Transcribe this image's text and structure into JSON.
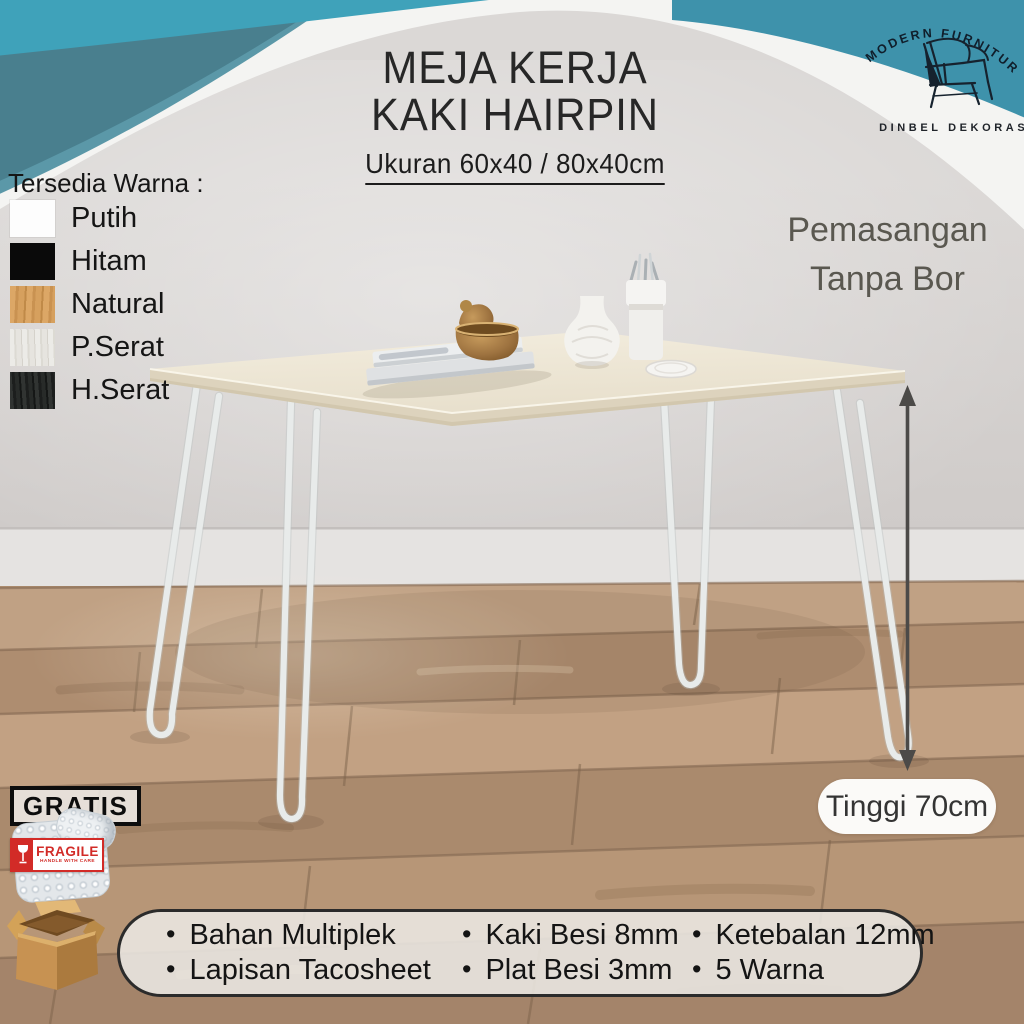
{
  "page": {
    "background": "#dbd8d6"
  },
  "header": {
    "title_line1": "MEJA KERJA",
    "title_line2": "KAKI HAIRPIN",
    "size_note": "Ukuran 60x40 / 80x40cm"
  },
  "brand": {
    "arc_text": "MODERN FURNITURE",
    "name": "DINBEL DEKORASI"
  },
  "color_options": {
    "heading": "Tersedia Warna :",
    "items": [
      {
        "label": "Putih",
        "hex": "#fdfdfd"
      },
      {
        "label": "Hitam",
        "hex": "#0a0a0a"
      },
      {
        "label": "Natural",
        "hex": "#d8a35e"
      },
      {
        "label": "P.Serat",
        "hex": "#e9e7e1"
      },
      {
        "label": "H.Serat",
        "hex": "#2c2f2e"
      }
    ]
  },
  "install_note": {
    "line1": "Pemasangan",
    "line2": "Tanpa Bor"
  },
  "dimension": {
    "height_label": "Tinggi 70cm"
  },
  "badges": {
    "gratis": "GRATIS",
    "fragile_title": "FRAGILE",
    "fragile_subtitle": "HANDLE WITH CARE"
  },
  "specs": {
    "items": [
      "Bahan Multiplek",
      "Kaki Besi 8mm",
      "Ketebalan 12mm",
      "Lapisan Tacosheet",
      "Plat Besi 3mm",
      "5 Warna"
    ]
  },
  "palette": {
    "teal_light": "#3fa2ba",
    "teal_dark": "#497f8e",
    "teal_corner": "#3e92ab",
    "swoosh_white": "#f4f4f2",
    "floor_wood": "#b49373",
    "accent_red": "#d22b27"
  }
}
